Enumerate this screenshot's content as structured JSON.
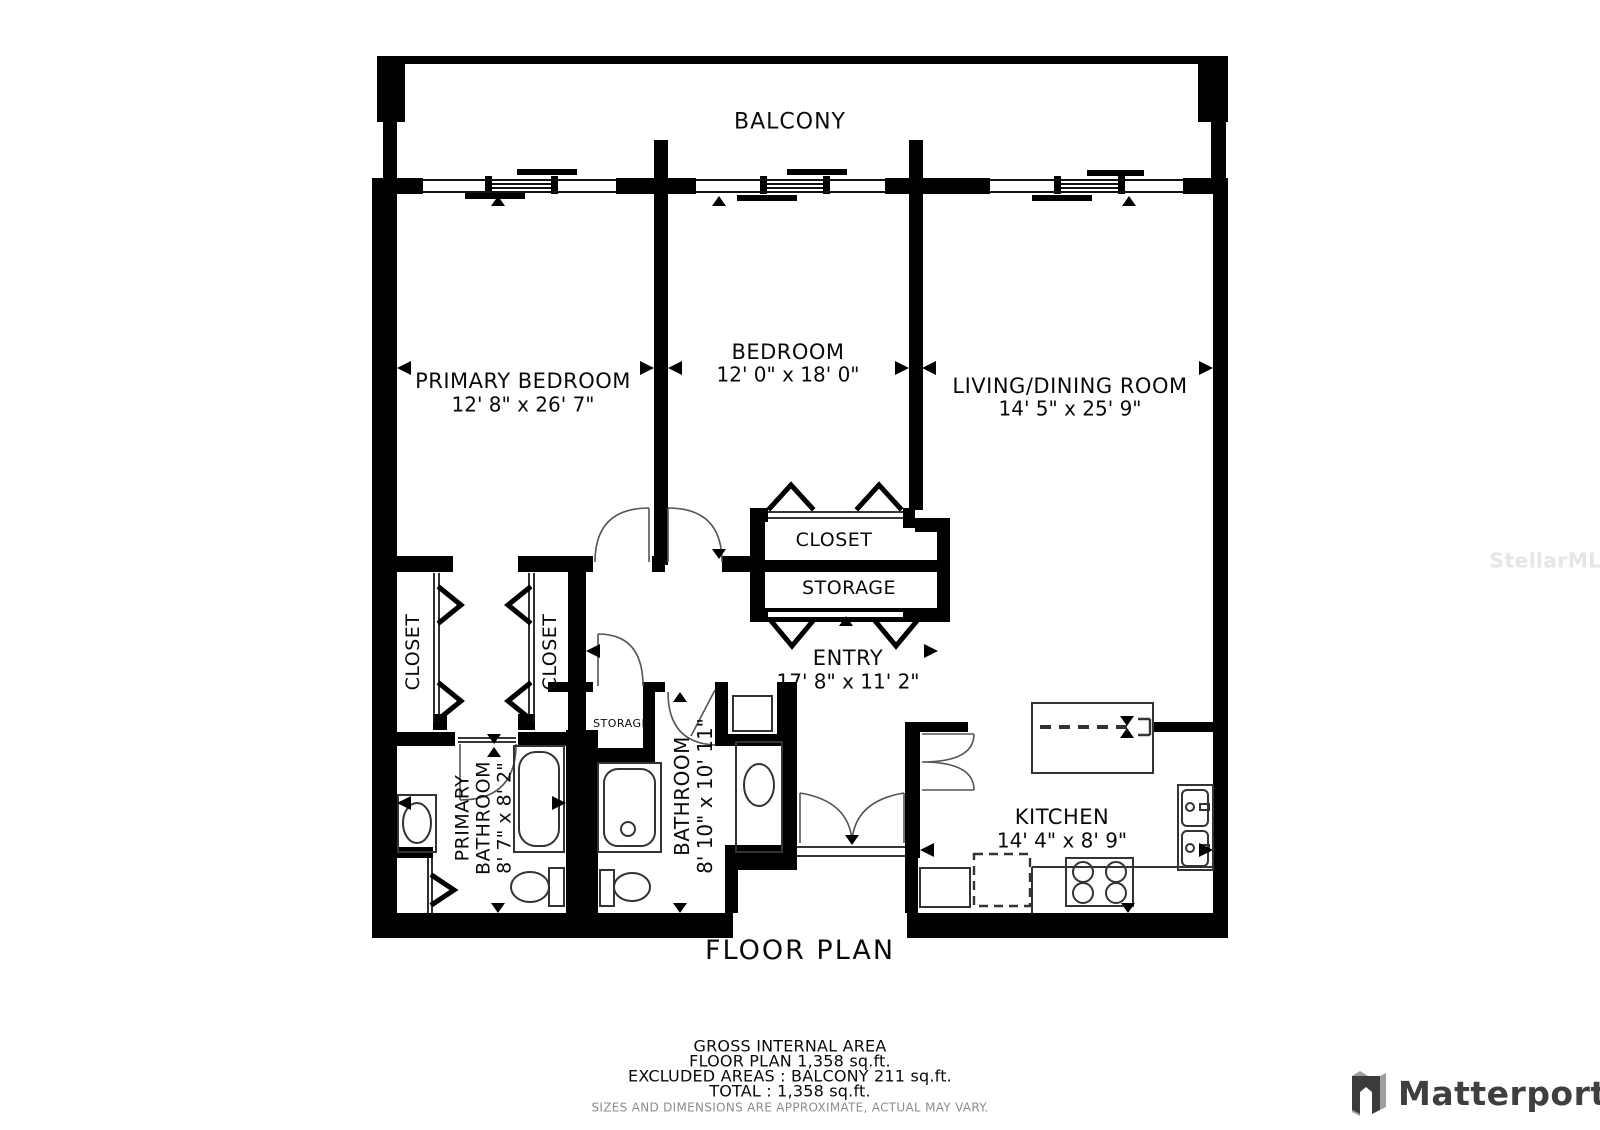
{
  "balcony": {
    "label": "BALCONY"
  },
  "rooms": {
    "primary_bedroom": {
      "name": "PRIMARY BEDROOM",
      "dims": "12' 8\" x 26' 7\""
    },
    "bedroom": {
      "name": "BEDROOM",
      "dims": "12' 0\" x 18' 0\""
    },
    "living_dining": {
      "name": "LIVING/DINING ROOM",
      "dims": "14' 5\" x 25' 9\""
    },
    "entry": {
      "name": "ENTRY",
      "dims": "17' 8\" x 11' 2\""
    },
    "kitchen": {
      "name": "KITCHEN",
      "dims": "14' 4\" x 8' 9\""
    },
    "primary_bathroom": {
      "line1": "PRIMARY",
      "line2": "BATHROOM",
      "dims": "8' 7\" x 8' 2\""
    },
    "bathroom": {
      "name": "BATHROOM",
      "dims": "8' 10\" x 10' 11\""
    }
  },
  "closets": {
    "bedroom_closet": "CLOSET",
    "storage": "STORAGE",
    "primary_closet_left": "CLOSET",
    "primary_closet_right": "CLOSET",
    "hall_storage": "STORAGE"
  },
  "title": "FLOOR PLAN",
  "area_summary": {
    "line1": "GROSS INTERNAL AREA",
    "line2": "FLOOR PLAN 1,358 sq.ft.",
    "line3": "EXCLUDED AREAS :  BALCONY 211 sq.ft.",
    "line4": "TOTAL :  1,358 sq.ft.",
    "disclaimer": "SIZES AND DIMENSIONS ARE APPROXIMATE, ACTUAL MAY VARY."
  },
  "watermark": "StellarMLS",
  "branding": {
    "name": "Matterport"
  },
  "colors": {
    "wall": "#000000",
    "fixture_line": "#3a3a3a",
    "brand_text": "#3f3f3f"
  }
}
